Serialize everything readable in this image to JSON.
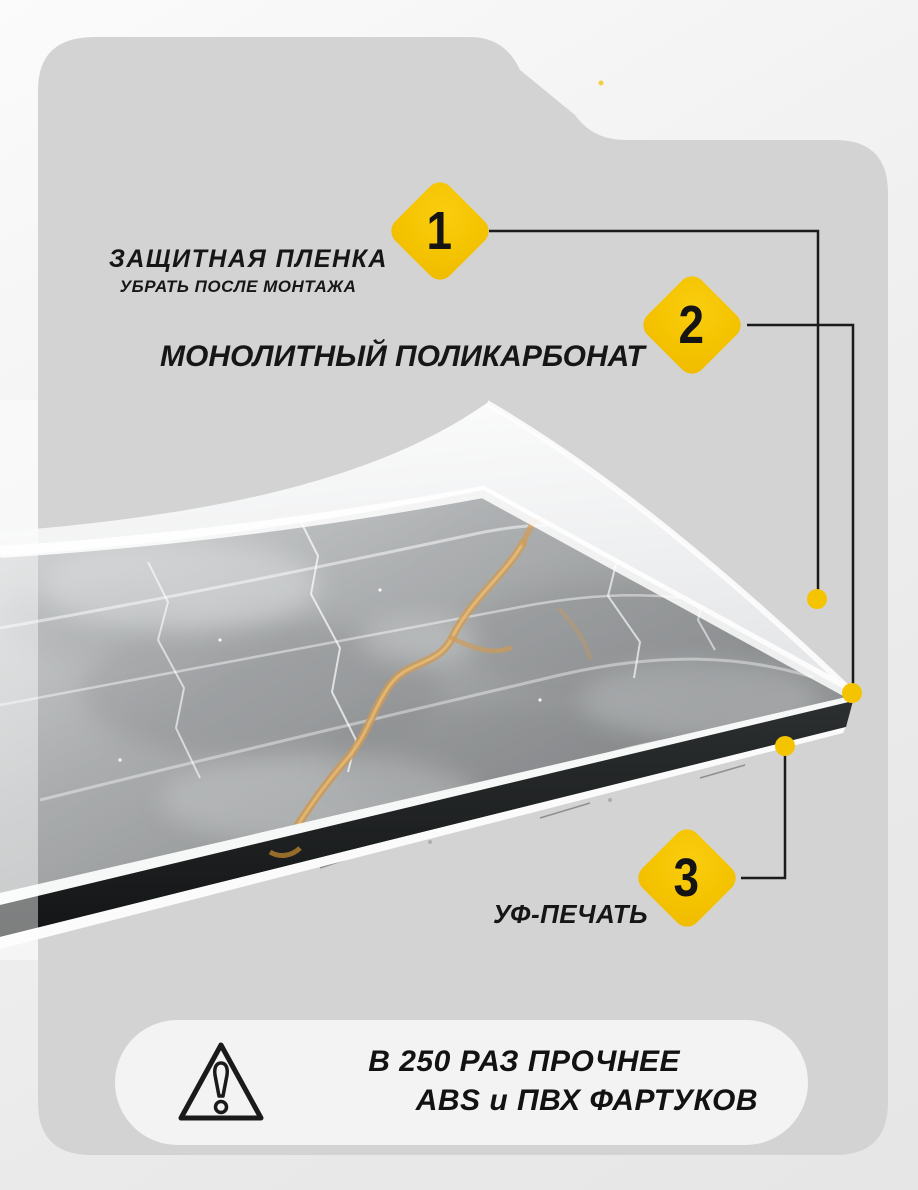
{
  "colors": {
    "background": "#f2f2f2",
    "card": "#d3d3d3",
    "accent_yellow": "#f5c400",
    "connector_line": "#1b1b1b",
    "marble_gold_vein": "#c08434",
    "text": "#161616",
    "uv_print_edge_black": "#17191a",
    "footnote_pill": "#f3f3f4"
  },
  "callouts": [
    {
      "number": "1",
      "label": "ЗАЩИТНАЯ ПЛЕНКА",
      "sublabel": "УБРАТЬ ПОСЛЕ МОНТАЖА"
    },
    {
      "number": "2",
      "label": "МОНОЛИТНЫЙ ПОЛИКАРБОНАТ"
    },
    {
      "number": "3",
      "label": "УФ-ПЕЧАТЬ"
    }
  ],
  "footnote": {
    "line1": "В 250 РАЗ ПРОЧНЕЕ",
    "line2": "ABS и ПВХ ФАРТУКОВ",
    "icon": "warning-triangle-icon"
  }
}
